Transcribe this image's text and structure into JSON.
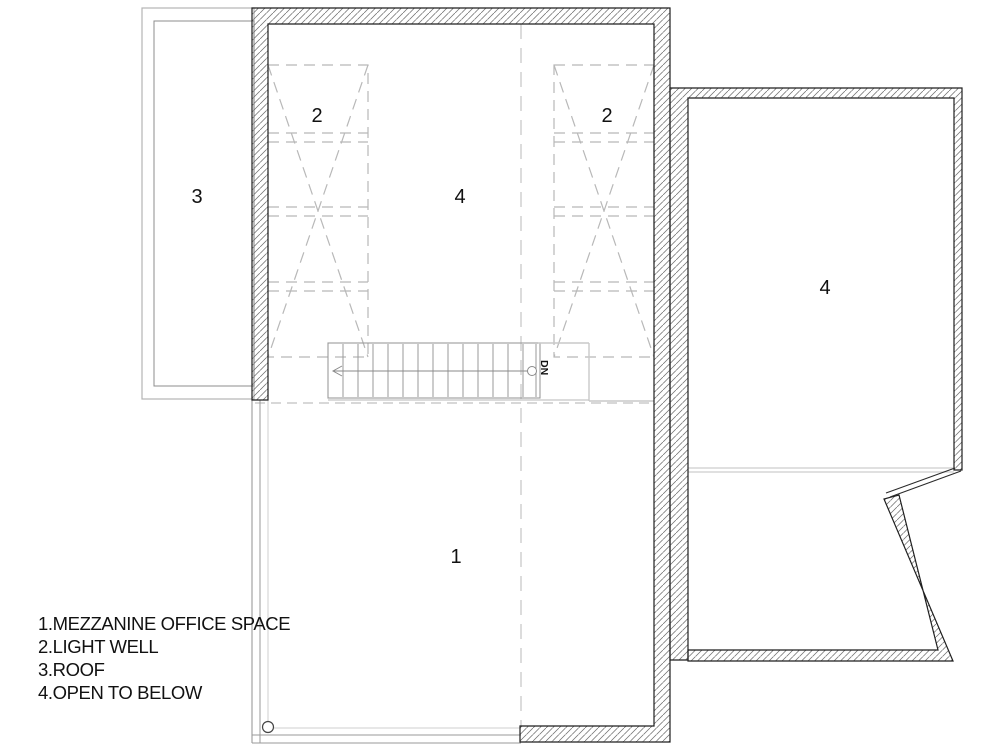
{
  "legend": {
    "items": [
      {
        "label": "1.MEZZANINE OFFICE SPACE"
      },
      {
        "label": "2.LIGHT WELL"
      },
      {
        "label": "3.ROOF"
      },
      {
        "label": "4.OPEN TO BELOW"
      }
    ]
  },
  "room_labels": {
    "mezzanine_office": "1",
    "light_well_left": "2",
    "light_well_right": "2",
    "roof": "3",
    "open_to_below_center": "4",
    "open_to_below_right": "4"
  },
  "stair": {
    "down_label": "DN"
  },
  "colors": {
    "background": "#ffffff",
    "wall_outline": "#1f1f1f",
    "hatch_line": "#6b6b6b",
    "dashed_line": "#b8b8b8",
    "stair_line": "#9a9a9a",
    "glazing_line": "#c9c9c9",
    "text": "#111111"
  }
}
